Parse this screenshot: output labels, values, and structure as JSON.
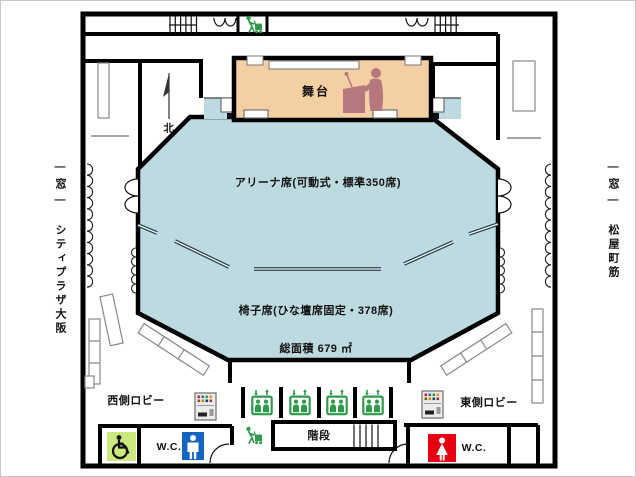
{
  "plan": {
    "stage_label": "舞台",
    "north_label": "北",
    "arena_seats_label": "アリーナ席(可動式・標準350席)",
    "chair_seats_label": "椅子席(ひな壇席固定・378席)",
    "total_area_label": "総面積 679 ㎡",
    "west_lobby_label": "西側ロビー",
    "east_lobby_label": "東側ロビー",
    "stairs_label": "階段",
    "west_wc_label": "W.C.",
    "east_wc_label": "W.C."
  },
  "surroundings": {
    "left_window_label": "―窓―",
    "left_street_label": "シティプラザ大阪",
    "right_window_label": "―窓―",
    "right_street_label": "松屋町筋"
  },
  "facts": {
    "arena_seats": 350,
    "chair_seats": 378,
    "total_area_m2": 679,
    "elevator_count": 4
  },
  "icons": {
    "north": "north-arrow",
    "podium": "speaker-at-podium",
    "elevator": "elevator-people-with-arrows",
    "stairs": "stairs-hatch",
    "porter": "person-pushing-cart",
    "wheelchair": "wheelchair-accessible-toilet",
    "mens_toilet": "man-silhouette",
    "womens_toilet": "woman-silhouette",
    "vending": "vending-machine",
    "double_door": "double-swing-door",
    "curtain": "curtain-scallops"
  },
  "colors": {
    "hall": "#bcdae0",
    "stage": "#f4cfa3",
    "podium": "#b5787f",
    "green": "#2e9b4b",
    "accessible": "#cbe97e",
    "men": "#1565c0",
    "women": "#e60012",
    "wall": "#000000",
    "divider": "#2b3f49"
  }
}
